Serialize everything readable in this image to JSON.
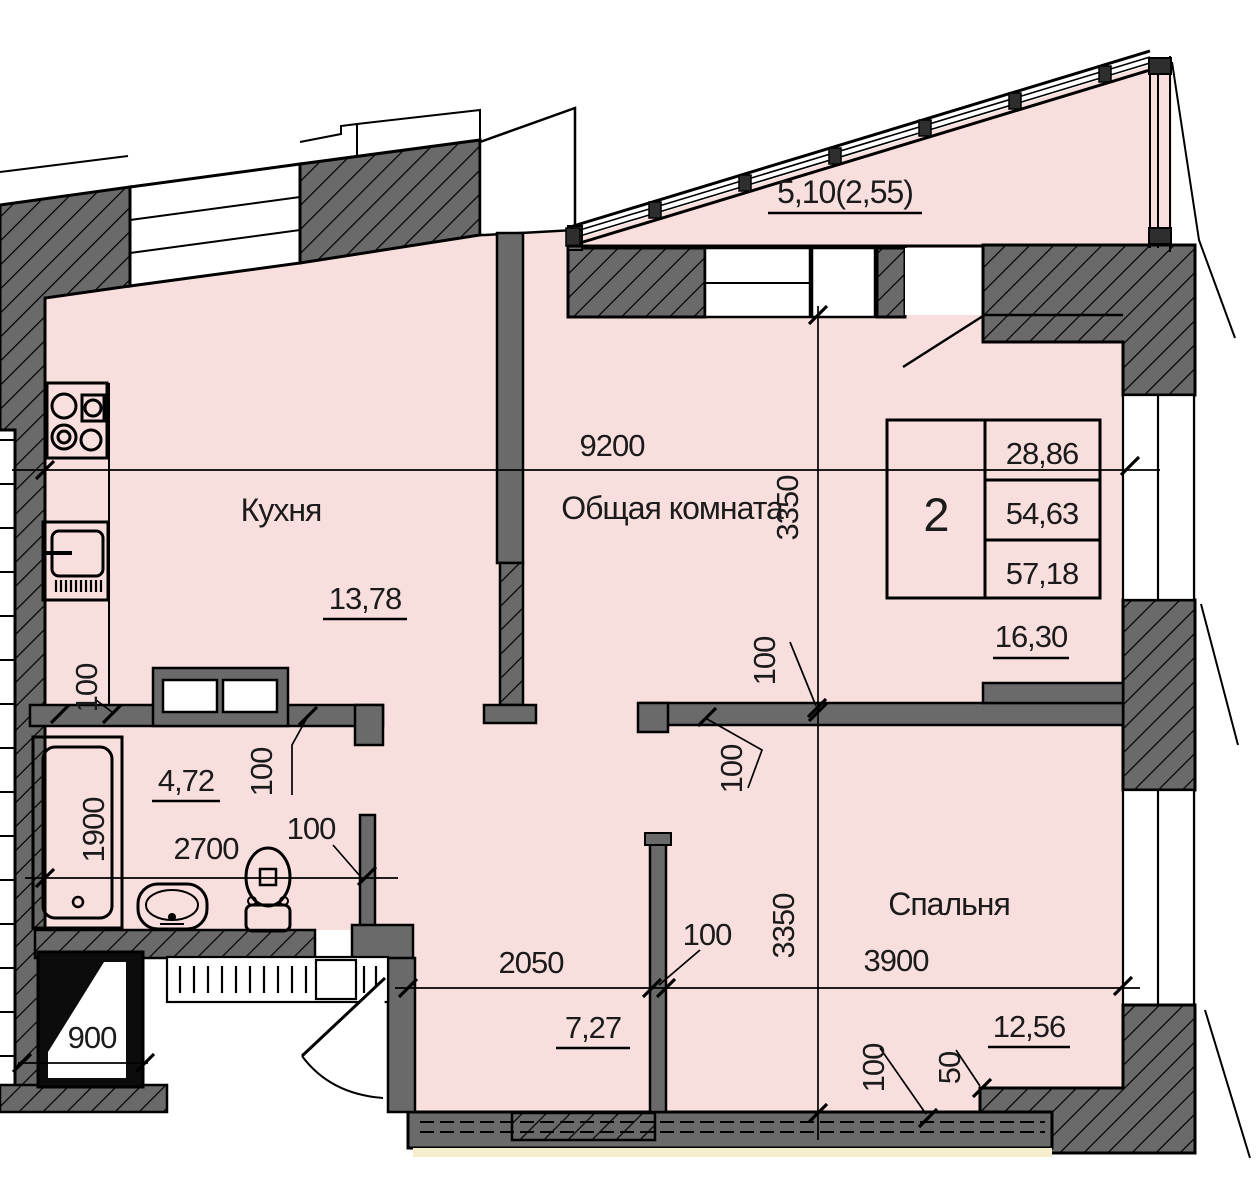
{
  "plan": {
    "balcony_area": "5,10(2,55)",
    "summary_area": "16,30",
    "rooms": {
      "kitchen": {
        "name": "Кухня",
        "area": "13,78"
      },
      "living": {
        "name": "Общая комната"
      },
      "bedroom": {
        "name": "Спальня",
        "area": "12,56"
      },
      "bathroom": {
        "area": "4,72"
      },
      "hall": {
        "area": "7,27"
      }
    },
    "info_table": {
      "room_count": "2",
      "living_area": "28,86",
      "usable_area": "54,63",
      "total_area": "57,18"
    },
    "dims": {
      "d9200": "9200",
      "d3350": "3350",
      "d2700": "2700",
      "d1900": "1900",
      "d2050": "2050",
      "d3900": "3900",
      "d900": "900",
      "d100": "100",
      "d50": "50"
    },
    "colors": {
      "room_fill": "#f8dfde",
      "wall_fill": "#6a6a6a",
      "sill_strip": "#f4eecd",
      "line": "#000000"
    }
  }
}
